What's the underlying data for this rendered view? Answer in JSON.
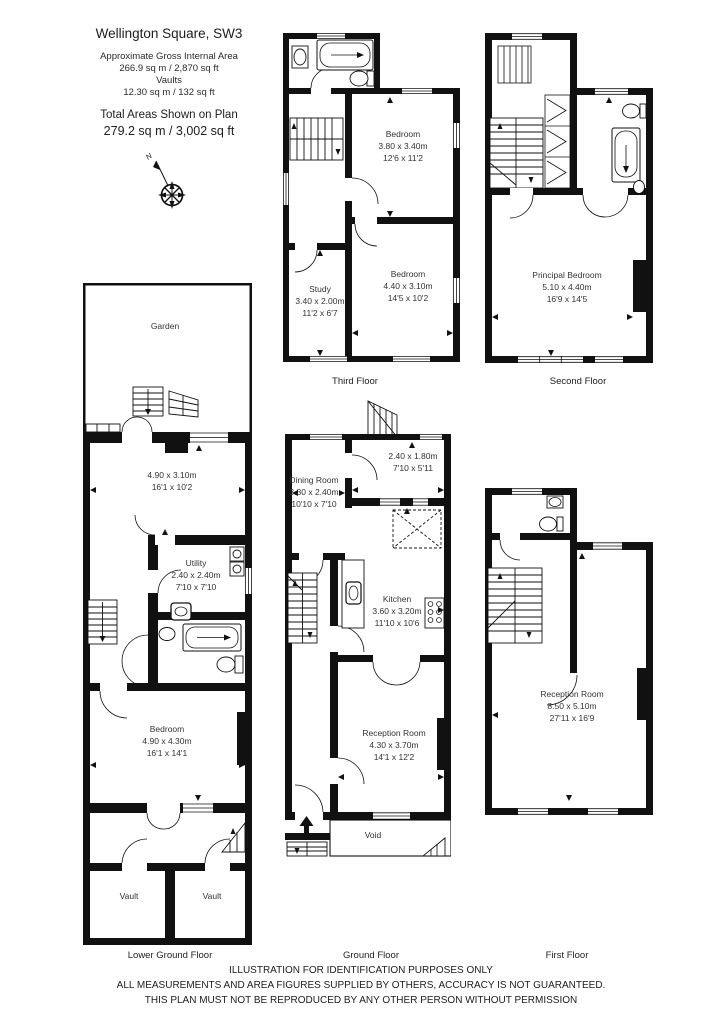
{
  "header": {
    "title": "Wellington Square, SW3",
    "gia_label": "Approximate Gross Internal Area",
    "gia_value": "266.9 sq m  /  2,870 sq ft",
    "vaults_label": "Vaults",
    "vaults_value": "12.30 sq m  /  132 sq ft",
    "total_label": "Total Areas Shown on Plan",
    "total_value": "279.2 sq m  /  3,002 sq ft"
  },
  "compass": {
    "north": "N"
  },
  "rooms": {
    "garden": {
      "name": "Garden"
    },
    "lgf_front_room": {
      "m": "4.90 x 3.10m",
      "ft": "16'1 x 10'2"
    },
    "utility": {
      "name": "Utility",
      "m": "2.40 x 2.40m",
      "ft": "7'10 x 7'10"
    },
    "lgf_bedroom": {
      "name": "Bedroom",
      "m": "4.90 x 4.30m",
      "ft": "16'1 x 14'1"
    },
    "vault_left": {
      "name": "Vault"
    },
    "vault_right": {
      "name": "Vault"
    },
    "gf_rear": {
      "m": "2.40 x 1.80m",
      "ft": "7'10 x 5'11"
    },
    "dining": {
      "name": "Dining Room",
      "m": "3.30 x 2.40m",
      "ft": "10'10 x 7'10"
    },
    "kitchen": {
      "name": "Kitchen",
      "m": "3.60 x 3.20m",
      "ft": "11'10 x 10'6"
    },
    "gf_reception": {
      "name": "Reception Room",
      "m": "4.30 x 3.70m",
      "ft": "14'1 x 12'2"
    },
    "void": {
      "name": "Void"
    },
    "ff_reception": {
      "name": "Reception Room",
      "m": "8.50 x 5.10m",
      "ft": "27'11 x 16'9"
    },
    "principal_bedroom": {
      "name": "Principal Bedroom",
      "m": "5.10 x 4.40m",
      "ft": "16'9 x 14'5"
    },
    "tf_bedroom_rear": {
      "name": "Bedroom",
      "m": "3.80 x 3.40m",
      "ft": "12'6 x 11'2"
    },
    "study": {
      "name": "Study",
      "m": "3.40 x 2.00m",
      "ft": "11'2 x 6'7"
    },
    "tf_bedroom_front": {
      "name": "Bedroom",
      "m": "4.40 x 3.10m",
      "ft": "14'5 x 10'2"
    }
  },
  "floor_labels": {
    "third": "Third Floor",
    "second": "Second Floor",
    "lower_ground": "Lower Ground Floor",
    "ground": "Ground Floor",
    "first": "First Floor"
  },
  "footer": {
    "line1": "ILLUSTRATION FOR IDENTIFICATION PURPOSES ONLY",
    "line2": "ALL MEASUREMENTS AND AREA FIGURES SUPPLIED BY OTHERS, ACCURACY IS NOT GUARANTEED.",
    "line3": "THIS PLAN MUST NOT BE REPRODUCED BY ANY OTHER PERSON WITHOUT PERMISSION"
  },
  "colors": {
    "wall": "#111111",
    "text": "#333333",
    "background": "#ffffff"
  }
}
